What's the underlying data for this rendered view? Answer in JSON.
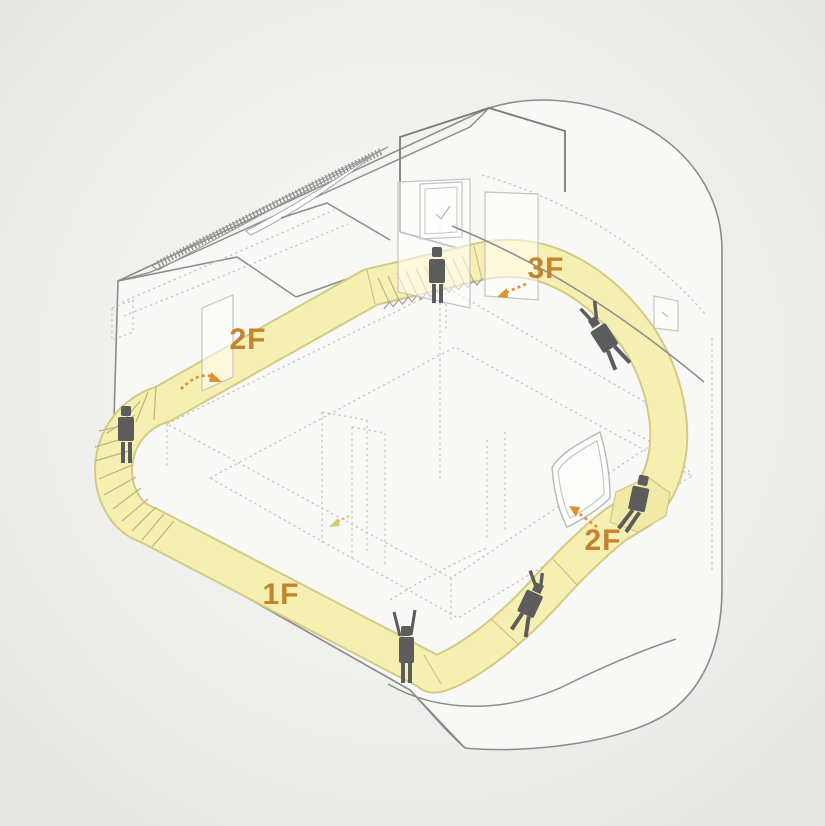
{
  "diagram": {
    "floor_labels": {
      "left_2f": "2F",
      "top_3f": "3F",
      "right_2f": "2F",
      "bottom_1f": "1F"
    },
    "colors": {
      "background": "#ededeb",
      "outline_gray": "#8c8c8a",
      "penthouse_gray": "#7b7b79",
      "dashed_gray": "#c2c2c0",
      "path_yellow": "#f5efb2",
      "path_edge": "#d5ca85",
      "tread_line": "#bdb37c",
      "label_orange": "#c5832e",
      "arrow_orange": "#df902f",
      "arrow_yellow": "#d9c96e",
      "figure_gray": "#5c5c5c"
    },
    "figures": [
      {
        "id": "person-standing-on-spiral-stair-icon",
        "pose": "standing"
      },
      {
        "id": "person-standing-at-3f-stair-icon",
        "pose": "standing"
      },
      {
        "id": "person-lying-on-upper-ramp-icon",
        "pose": "lying"
      },
      {
        "id": "person-sitting-on-2f-ledge-icon",
        "pose": "sitting"
      },
      {
        "id": "person-lying-on-lower-ramp-icon",
        "pose": "lying"
      },
      {
        "id": "person-standing-arms-raised-icon",
        "pose": "standing-arms-up"
      }
    ],
    "arrows": [
      {
        "id": "arrow-2f-left",
        "direction": "curving-right"
      },
      {
        "id": "arrow-3f-top",
        "direction": "down-left"
      },
      {
        "id": "arrow-2f-right",
        "direction": "up-left"
      },
      {
        "id": "arrow-center-floor",
        "direction": "down-left"
      }
    ]
  }
}
